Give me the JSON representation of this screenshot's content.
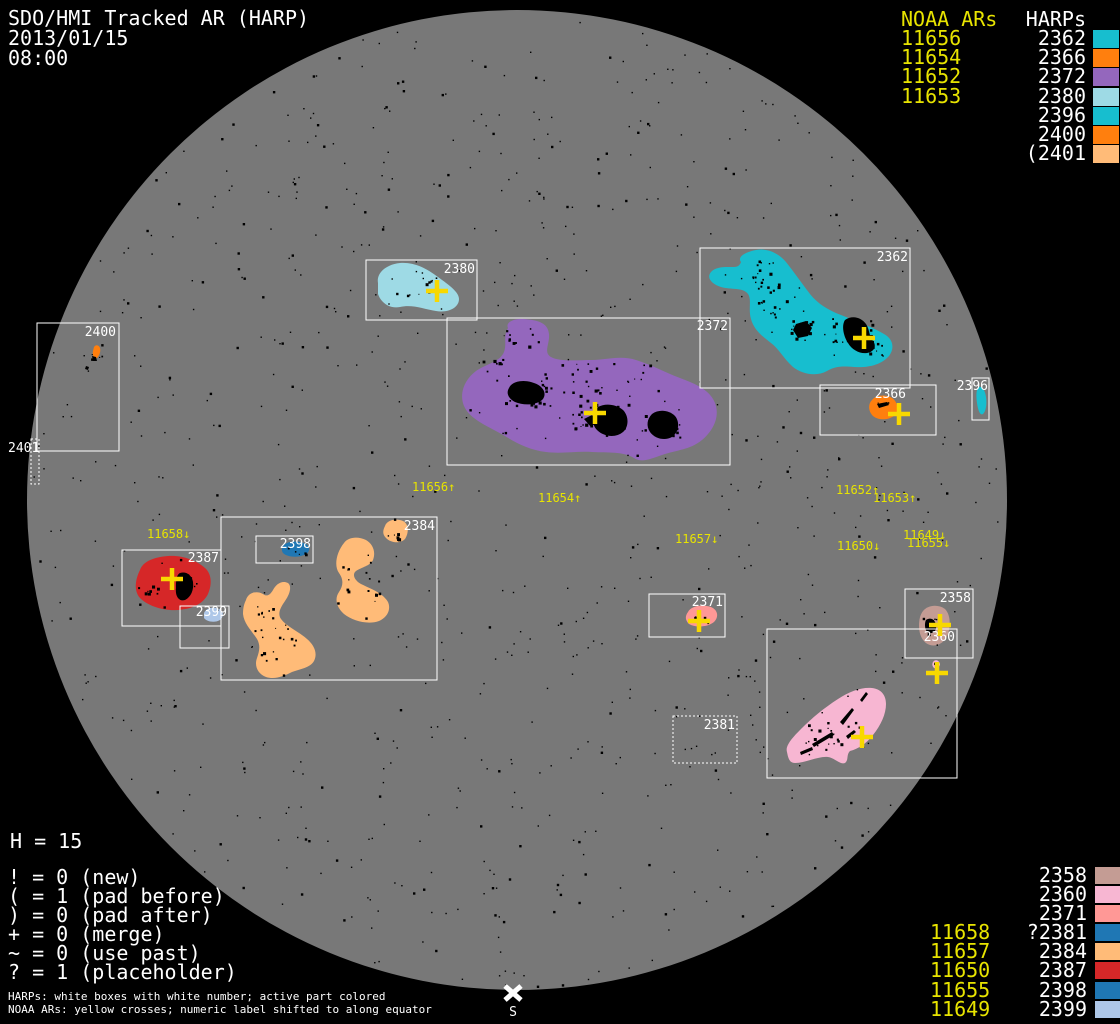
{
  "header": {
    "title": "SDO/HMI Tracked AR (HARP)",
    "date": "2013/01/15",
    "time": "08:00"
  },
  "disk": {
    "color": "#787878",
    "background": "#000000"
  },
  "legend_top_right": {
    "noaa_header": "NOAA ARs",
    "harps_header": "HARPs",
    "rows": [
      {
        "noaa": "11656",
        "harp": "2362",
        "color": "#17becf"
      },
      {
        "noaa": "11654",
        "harp": "2366",
        "color": "#ff7f0e"
      },
      {
        "noaa": "11652",
        "harp": "2372",
        "color": "#9467bd"
      },
      {
        "noaa": "11653",
        "harp": "2380",
        "color": "#9edae5"
      },
      {
        "noaa": "",
        "harp": "2396",
        "color": "#17becf"
      },
      {
        "noaa": "",
        "harp": "2400",
        "color": "#ff7f0e"
      },
      {
        "noaa": "",
        "harp": "(2401",
        "color": "#ffbb78"
      }
    ]
  },
  "legend_bottom_right": {
    "rows": [
      {
        "noaa": "",
        "harp": "2358",
        "color": "#c49c94"
      },
      {
        "noaa": "",
        "harp": "2360",
        "color": "#f7b6d2"
      },
      {
        "noaa": "",
        "harp": "2371",
        "color": "#ff9896"
      },
      {
        "noaa": "11658",
        "harp": "?2381",
        "color": "#1f77b4"
      },
      {
        "noaa": "11657",
        "harp": "2384",
        "color": "#ffbb78"
      },
      {
        "noaa": "11650",
        "harp": "2387",
        "color": "#d62728"
      },
      {
        "noaa": "11655",
        "harp": "2398",
        "color": "#1f77b4"
      },
      {
        "noaa": "11649",
        "harp": "2399",
        "color": "#aec7e8"
      }
    ]
  },
  "stats": {
    "h_line": "H = 15",
    "flags": [
      "! = 0 (new)",
      "( = 1 (pad before)",
      ") = 0 (pad after)",
      "+ = 0 (merge)",
      "~ = 0 (use past)",
      "? = 1 (placeholder)"
    ]
  },
  "footnotes": {
    "line1": "HARPs: white boxes with white number; active part colored",
    "line2": "NOAA ARs: yellow crosses; numeric label shifted to along equator"
  },
  "south_label": "S",
  "chart_data": {
    "type": "scatter",
    "title": "SDO/HMI Tracked AR (HARP)",
    "observed_date": "2013/01/15",
    "observed_time": "08:00",
    "harp_count_shown": 15,
    "regions": [
      {
        "harp": "2358",
        "color": "#c49c94",
        "box_px": [
          905,
          589,
          68,
          69
        ],
        "box_style": "solid"
      },
      {
        "harp": "2360",
        "color": "#f7b6d2",
        "box_px": [
          767,
          629,
          190,
          149
        ],
        "box_style": "solid"
      },
      {
        "harp": "2371",
        "color": "#ff9896",
        "box_px": [
          649,
          594,
          76,
          43
        ],
        "box_style": "solid"
      },
      {
        "harp": "2381",
        "color": "#1f77b4",
        "box_px": [
          673,
          716,
          64,
          47
        ],
        "box_style": "dotted"
      },
      {
        "harp": "2384",
        "color": "#ffbb78",
        "box_px": [
          221,
          517,
          216,
          163
        ],
        "box_style": "solid"
      },
      {
        "harp": "2387",
        "color": "#d62728",
        "box_px": [
          122,
          550,
          99,
          76
        ],
        "box_style": "solid"
      },
      {
        "harp": "2396",
        "color": "#17becf",
        "box_px": [
          972,
          378,
          17,
          42
        ],
        "box_style": "solid"
      },
      {
        "harp": "2398",
        "color": "#1f77b4",
        "box_px": [
          256,
          536,
          57,
          27
        ],
        "box_style": "solid"
      },
      {
        "harp": "2399",
        "color": "#aec7e8",
        "box_px": [
          180,
          606,
          49,
          42
        ],
        "box_style": "solid"
      },
      {
        "harp": "2400",
        "color": "#ff7f0e",
        "box_px": [
          37,
          323,
          82,
          128
        ],
        "box_style": "solid"
      },
      {
        "harp": "2401",
        "color": "#ffbb78",
        "box_px": [
          31,
          439,
          8,
          45
        ],
        "box_style": "dotted"
      },
      {
        "harp": "2362",
        "color": "#17becf",
        "box_px": [
          700,
          248,
          210,
          140
        ],
        "box_style": "solid"
      },
      {
        "harp": "2366",
        "color": "#ff7f0e",
        "box_px": [
          820,
          385,
          116,
          50
        ],
        "box_style": "solid"
      },
      {
        "harp": "2372",
        "color": "#9467bd",
        "box_px": [
          447,
          318,
          283,
          147
        ],
        "box_style": "solid"
      },
      {
        "harp": "2380",
        "color": "#9edae5",
        "box_px": [
          366,
          260,
          111,
          60
        ],
        "box_style": "solid"
      }
    ],
    "noaa_labels": [
      {
        "text": "11658↓",
        "x": 147,
        "y": 538
      },
      {
        "text": "11656↑",
        "x": 412,
        "y": 491
      },
      {
        "text": "11654↑",
        "x": 538,
        "y": 502
      },
      {
        "text": "11657↓",
        "x": 675,
        "y": 543
      },
      {
        "text": "11652↑",
        "x": 836,
        "y": 494
      },
      {
        "text": "11653↑",
        "x": 873,
        "y": 502
      },
      {
        "text": "11650↓",
        "x": 837,
        "y": 550
      },
      {
        "text": "11649↓",
        "x": 903,
        "y": 539
      },
      {
        "text": "11655↓",
        "x": 907,
        "y": 547
      }
    ],
    "crosses_px": [
      [
        437,
        291
      ],
      [
        595,
        413
      ],
      [
        864,
        338
      ],
      [
        899,
        414
      ],
      [
        172,
        579
      ],
      [
        699,
        621
      ],
      [
        940,
        625
      ],
      [
        937,
        673
      ],
      [
        862,
        737
      ]
    ],
    "cross_color": "#f8d800"
  }
}
